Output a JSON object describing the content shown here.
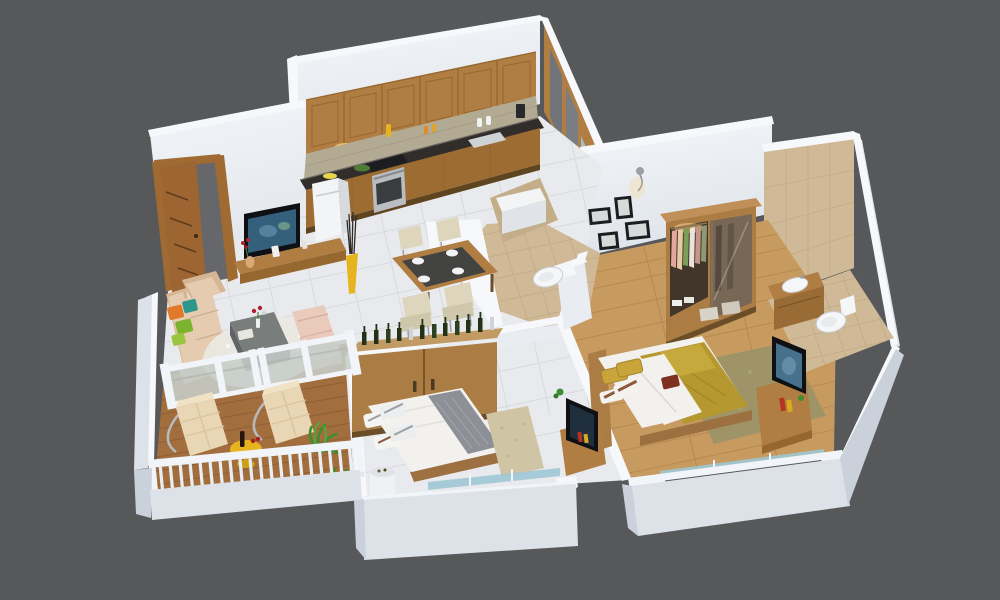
{
  "scene": {
    "type": "isometric-3d-floor-plan-render",
    "subject": "2BHK apartment cutaway 3D floor plan",
    "background": "#57585a"
  },
  "palette": {
    "bg": "#57585a",
    "wallTop": "#f6f8fb",
    "wallFace": "#e9edf2",
    "wallFaceDim": "#dde2e9",
    "plinth": "#dde2e9",
    "plinthDark": "#cbd1da",
    "tileFloor": "#e8eaed",
    "tileLine": "#d7dade",
    "bathTile": "#cfb996",
    "bathTileLine": "#bfa883",
    "woodFloor": "#c79a5f",
    "woodPlankLine": "#b3854c",
    "deckWood": "#a26e3e",
    "deckPlankLine": "#8a5a33",
    "cabinetWood": "#b07d42",
    "cabinetWoodDark": "#96682f",
    "counterTop": "#312d2a",
    "backsplash": "#b2aa92",
    "sofaBeige": "#e5cbaf",
    "sofaShade": "#d6b795",
    "cushionOrange": "#e0792b",
    "cushionGreen": "#7cb32e",
    "cushionTeal": "#2f968c",
    "rugWhite": "#eae8e2",
    "ottomanPink": "#e9cabb",
    "tableGray": "#797d7b",
    "tableGrayDark": "#54575a",
    "tvBlack": "#0e1013",
    "tvScreen": "#34607c",
    "accentYellow": "#e6b41e",
    "plantGreen": "#3e8e2e",
    "railWhite": "#f1f4f8",
    "glassFrosted": "#c6cec9",
    "glassBlue": "#9fc6d4",
    "bedWhite": "#f2f1ee",
    "runnerGray": "#8d9197",
    "masterOlive": "#b5982f",
    "masterOliveLight": "#c6a93c",
    "pillowMustard": "#c9a43a",
    "cushionMaroon": "#7e3020",
    "rugOlive": "#9a9468",
    "rugBeige": "#cfc4a4",
    "doorWood": "#a06a33",
    "wardrobeWood": "#ab7d45",
    "toiletWhite": "#f5f6f8",
    "frameBlack": "#1c1d1f",
    "lampGlow": "#ffd27f"
  },
  "rooms": [
    {
      "name": "living-room",
      "furniture": [
        "entrance-door",
        "wall-tv",
        "tv-console-shelf",
        "l-shaped-sofa",
        "throw-pillows",
        "coffee-table",
        "shag-rug",
        "ottomans",
        "yellow-floor-vase"
      ]
    },
    {
      "name": "kitchen",
      "furniture": [
        "upper-cabinets",
        "under-cabinet-lights",
        "mosaic-backsplash",
        "granite-countertop",
        "lower-cabinets",
        "oven",
        "hob",
        "sink",
        "refrigerator",
        "white-counter-block"
      ]
    },
    {
      "name": "dining-area",
      "furniture": [
        "dining-table",
        "four-chairs",
        "place-settings"
      ]
    },
    {
      "name": "common-bathroom",
      "furniture": [
        "shower-mixer",
        "wall-hung-toilet",
        "tiled-floor"
      ]
    },
    {
      "name": "bedroom-two",
      "furniture": [
        "sliding-wardrobe",
        "display-bottles",
        "double-bed",
        "striped-pillows",
        "white-floor-vase",
        "area-rug",
        "tv-unit",
        "sliding-window"
      ]
    },
    {
      "name": "master-bedroom",
      "furniture": [
        "photo-frames",
        "wall-lamp",
        "open-wardrobe",
        "double-bed",
        "olive-bedding",
        "area-rug",
        "tv-unit",
        "sliding-window"
      ]
    },
    {
      "name": "ensuite-bathroom",
      "furniture": [
        "vanity-basin",
        "toilet",
        "beige-tiled-wall"
      ]
    },
    {
      "name": "balcony",
      "furniture": [
        "lounge-chairs",
        "yellow-side-table",
        "wine-bottle",
        "potted-plants",
        "white-railing",
        "wooden-deck"
      ]
    }
  ]
}
